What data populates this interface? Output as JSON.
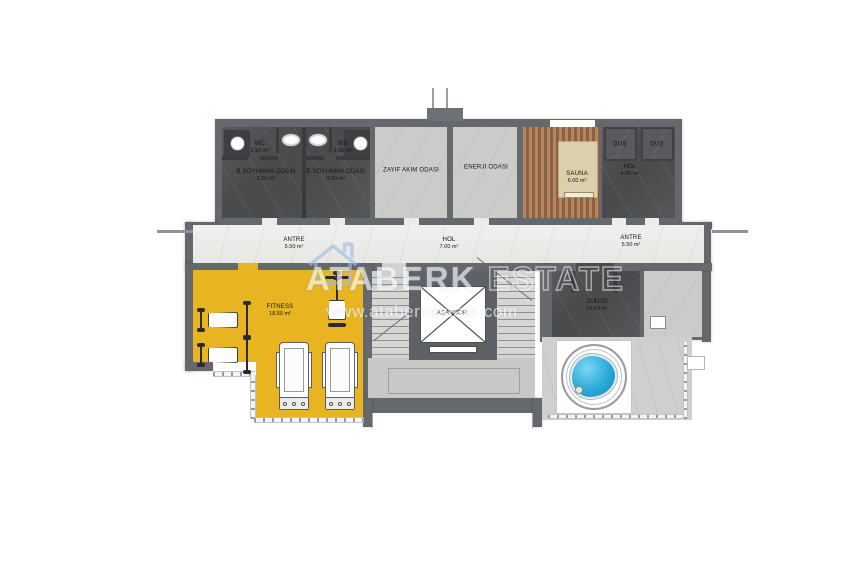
{
  "watermark": {
    "brand": "ATABERK",
    "brand2": "ESTATE",
    "url": "www.ataberkestate.com"
  },
  "rooms": {
    "wc_left": {
      "name": "WC",
      "area": "2.50 m²"
    },
    "wc_right": {
      "name": "WC",
      "area": "2.50 m²"
    },
    "dressing_b": {
      "name": "B.SOYUNMA ODASI",
      "area": "3.50 m²"
    },
    "dressing_e": {
      "name": "E.SOYUNMA ODASI",
      "area": "3.50 m²"
    },
    "low_current": {
      "name": "ZAYIF AKIM ODASI"
    },
    "energy": {
      "name": "ENERJİ ODASI"
    },
    "sauna": {
      "name": "SAUNA",
      "area": "6.00 m²"
    },
    "shower_left": {
      "name": "DUŞ"
    },
    "shower_right": {
      "name": "DUŞ"
    },
    "hall_top": {
      "name": "HOL",
      "area": "4.00 m²"
    },
    "entry_left": {
      "name": "ANTRE",
      "area": "5.50 m²"
    },
    "hall_center": {
      "name": "HOL",
      "area": "7.00 m²"
    },
    "entry_right": {
      "name": "ANTRE",
      "area": "5.50 m²"
    },
    "fitness": {
      "name": "FITNESS",
      "area": "18.50 m²"
    },
    "elevator": {
      "name": "ASANSÖR"
    },
    "jacuzzi": {
      "name": "JAKUZİ",
      "area": "10.50 m²"
    }
  },
  "colors": {
    "wall": "#65686c",
    "fitness_floor": "#e9b421",
    "pool_water": "#2aa9da",
    "sauna_wood": "#a97c59",
    "watermark_logo": "#a3bedd"
  }
}
